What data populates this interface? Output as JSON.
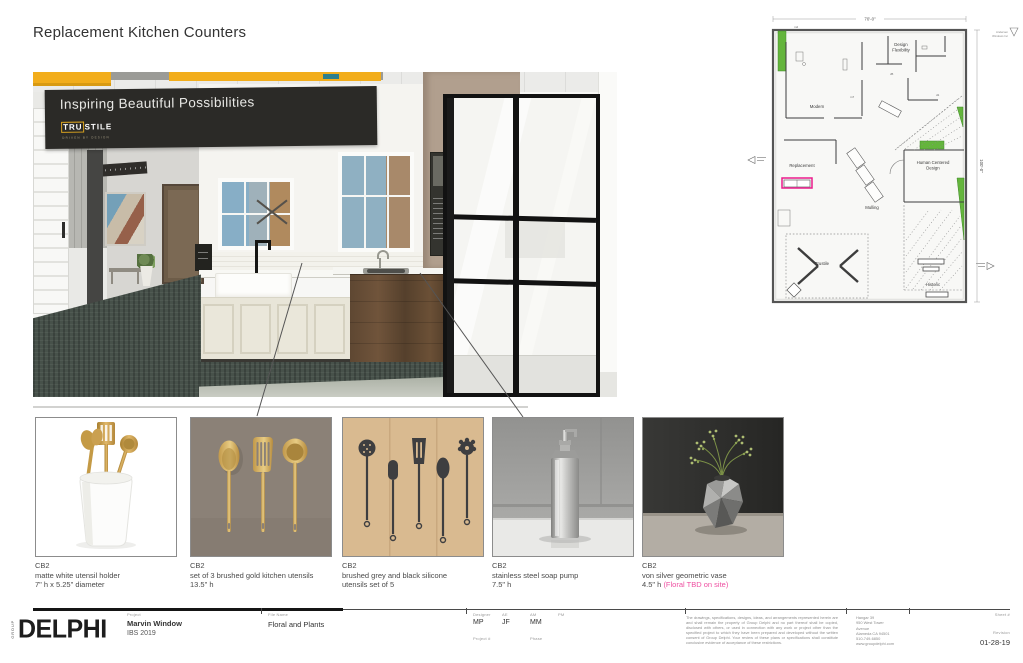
{
  "page": {
    "title": "Replacement Kitchen Counters"
  },
  "render": {
    "banner_title": "Inspiring Beautiful Possibilities",
    "brand_tru": "TRU",
    "brand_stile": "STILE",
    "brand_tagline": "DRIVEN BY DESIGN"
  },
  "plan": {
    "dim_width": "70'-0\"",
    "dim_height": "100'-0\"",
    "note_1": "Andersen",
    "note_2": "Windows Inc",
    "rooms": {
      "modern": "Modern",
      "design_1": "Design",
      "design_2": "Flexibility",
      "replacement": "Replacement",
      "mulling": "Mulling",
      "human_1": "Human Centered",
      "human_2": "Design",
      "trustile": "Trustile",
      "historic": "Historic"
    },
    "codes": [
      "m2",
      "m7",
      "d5",
      "d1"
    ]
  },
  "products": [
    {
      "brand": "CB2",
      "desc1": "matte white utensil holder",
      "desc2": "7\" h x 5.25\" diameter"
    },
    {
      "brand": "CB2",
      "desc1": "set of 3 brushed gold kitchen utensils",
      "desc2": "13.5\" h"
    },
    {
      "brand": "CB2",
      "desc1": "brushed grey and black silicone",
      "desc2": "utensils set of 5"
    },
    {
      "brand": "CB2",
      "desc1": "stainless steel soap pump",
      "desc2": "7.5\" h"
    },
    {
      "brand": "CB2",
      "desc1": "von silver geometric vase",
      "desc2": "4.5\" h ",
      "note": "(Floral TBD on site)"
    }
  ],
  "titleblock": {
    "logo_group": "GROUP",
    "logo_name": "DELPHI",
    "project_label": "Project",
    "project_name": "Marvin Window",
    "project_sub": "IBS 2019",
    "file_label": "File Name",
    "file_name": "Floral and Plants",
    "designer_label": "Designer",
    "designer": "MP",
    "ae_label": "AE",
    "ae": "JF",
    "am_label": "AM",
    "am": "MM",
    "pm_label": "PM",
    "pm": "",
    "project_num_label": "Project #",
    "phase_label": "Phase",
    "legal": "The drawings, specifications, designs, ideas, and arrangements represented herein are and shall remain the property of Group Delphi and no part thereof shall be copied, disclosed with others, or used in connection with any work or project other than the specified project to which they have been prepared and developed without the written consent of Group Delphi. Your review of these plans or specifications shall constitute conclusive evidence of acceptance of these restrictions.",
    "address": [
      "Hangar 39",
      "950 West Tower",
      "Avenue",
      "Alameda CA 94501",
      "510-749-6850",
      "www.groupdelphi.com"
    ],
    "sheet_label": "Sheet #",
    "revision_label": "Revision",
    "date": "01-28-19"
  },
  "colors": {
    "accent_pink": "#EE4FA1",
    "plan_highlight": "#EA1A8C",
    "plan_green": "#64B53C",
    "beam_yellow": "#F2AD1B",
    "carpet_green": "#47514A"
  }
}
